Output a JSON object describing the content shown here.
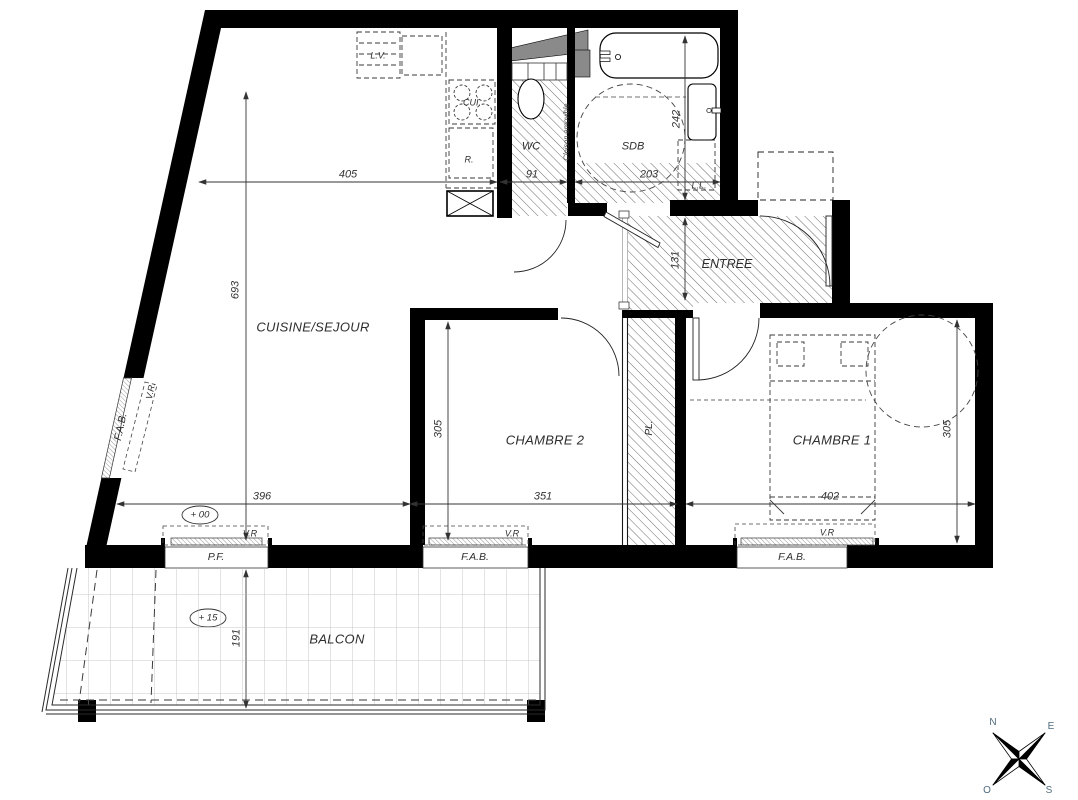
{
  "rooms": {
    "cuisine_sejour": "CUISINE/SEJOUR",
    "chambre2": "CHAMBRE 2",
    "chambre1": "CHAMBRE 1",
    "entree": "ENTREE",
    "wc": "WC",
    "sdb": "SDB",
    "balcon": "BALCON",
    "placard": "PL."
  },
  "dimensions": {
    "sejour_width": "405",
    "sejour_depth": "693",
    "wc_width": "91",
    "sdb_width": "203",
    "sdb_depth": "242",
    "entree_depth": "131",
    "chambre2_depth": "305",
    "chambre2_width": "351",
    "chambre1_width": "402",
    "chambre1_depth": "305",
    "sejour_bottom_width": "396",
    "balcon_depth": "191"
  },
  "openings": {
    "fab": "F.A.B.",
    "pf": "P.F.",
    "vr": "V.R",
    "vr_dotted": "V.R."
  },
  "equipment": {
    "dishwasher": "L.V.",
    "cooktop": "CUI.",
    "fridge": "R.",
    "washer": "L.L."
  },
  "annotations": {
    "partition": "Cloison amovible",
    "level_main": "+ 00",
    "level_balcony": "+ 15"
  },
  "compass": {
    "north": "N",
    "east": "E",
    "west": "O",
    "south": "S"
  }
}
